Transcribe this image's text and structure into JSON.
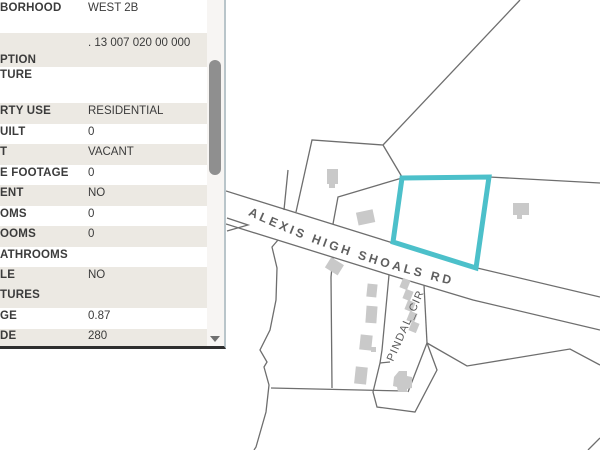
{
  "panel": {
    "rows": [
      {
        "label": "BORHOOD",
        "value": "WEST 2B"
      },
      {
        "label": "",
        "label2": "PTION",
        "value": ". 13 007 020 00 000"
      },
      {
        "label": "TURE",
        "value": ""
      },
      {
        "label": "RTY USE",
        "value": "RESIDENTIAL"
      },
      {
        "label": "UILT",
        "value": "0"
      },
      {
        "label": "T",
        "value": "VACANT"
      },
      {
        "label": "E FOOTAGE",
        "value": "0"
      },
      {
        "label": "ENT",
        "value": "NO"
      },
      {
        "label": "OMS",
        "value": "0"
      },
      {
        "label": "OOMS",
        "value": "0"
      },
      {
        "label": "ATHROOMS",
        "value": ""
      },
      {
        "label": "LE",
        "label2": "TURES",
        "value": "NO"
      },
      {
        "label": "GE",
        "value": "0.87"
      },
      {
        "label": "DE",
        "value": "280"
      }
    ]
  },
  "map": {
    "road_label": "ALEXIS HIGH SHOALS RD",
    "side_road_label": "PINDAL_CIR",
    "colors": {
      "highlight": "#4cc0ca",
      "parcel_line": "#6e6e6e",
      "building": "#c9c9c9",
      "road_label_color": "#5f5f5f"
    }
  }
}
